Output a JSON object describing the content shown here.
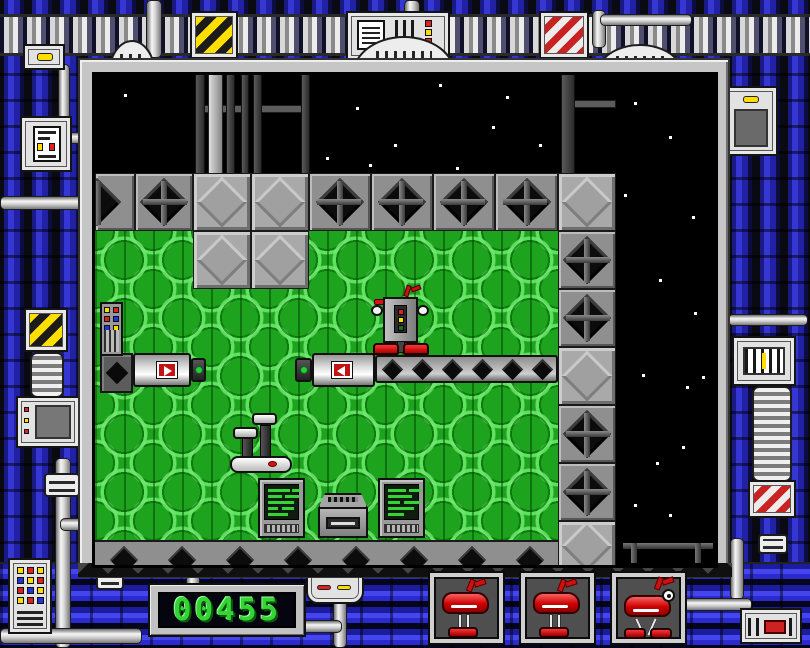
{
  "hud": {
    "score": {
      "value": "00455",
      "lcd_color": "#35d435",
      "screen_color": "#05050f"
    },
    "lives": [
      {
        "id": 1,
        "sprite": "red-robot-idle"
      },
      {
        "id": 2,
        "sprite": "red-robot-idle"
      },
      {
        "id": 3,
        "sprite": "red-robot-walker"
      }
    ]
  },
  "playfield": {
    "entities": [
      "player-robot",
      "pusher-machine-right",
      "pusher-machine-left",
      "conveyor-belt",
      "periscope-machine",
      "terminal",
      "disk-drive",
      "control-panel",
      "wall-diamond-tile",
      "crate-tile",
      "scaffold-pillars",
      "space-railing"
    ],
    "colors": {
      "floor_green": "#1ea31e",
      "floor_ring": "#6eeb6e",
      "space_black": "#000000",
      "wall_gray": "#8f8f8f",
      "crate_gray": "#a9a9a9",
      "diamond_black": "#0c0c0c"
    }
  },
  "frame": {
    "colors": {
      "pipe_blue": "#3636d2",
      "pipe_white": "#ededed",
      "hazard_yellow": "#ffdf00",
      "hazard_red": "#c92222",
      "light_red": "#dd2222",
      "light_yellow": "#ffdd00",
      "light_green": "#2ecc2e"
    },
    "gadgets": [
      "hazard-panel-yellow",
      "status-panel",
      "hazard-panel-red",
      "lamp-panel",
      "control-box",
      "monitor",
      "keypad",
      "barcode-panel",
      "ribbed-cylinder",
      "vent-device",
      "signal-device"
    ]
  }
}
